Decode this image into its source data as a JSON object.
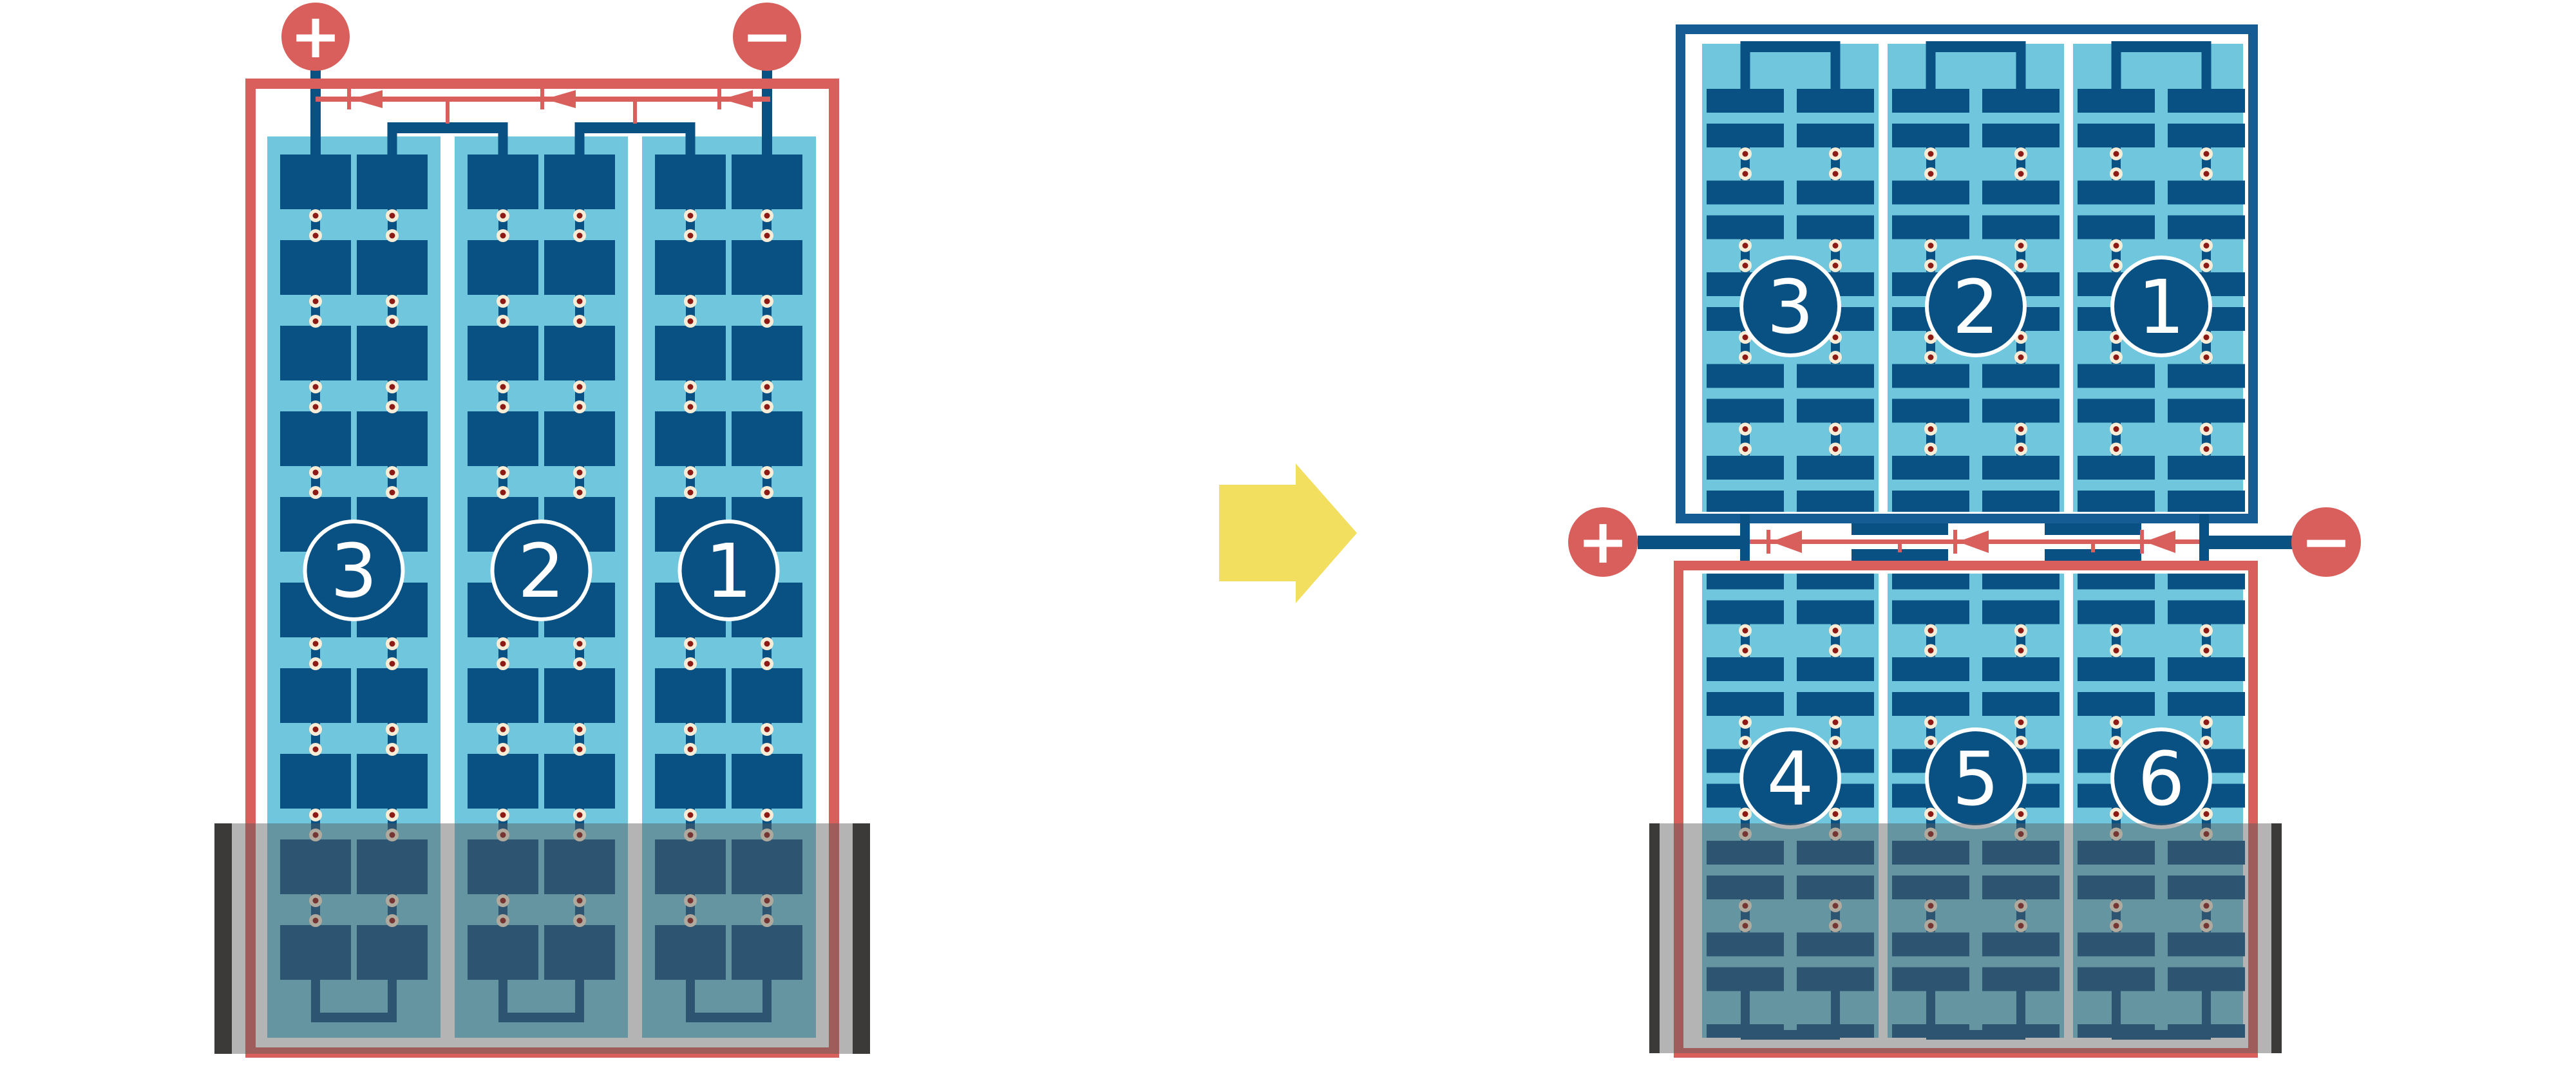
{
  "title": "Battery cell-stack series connection diagram: single battery rearranged into stacked dual module pack",
  "colors": {
    "background": "#ffffff",
    "red": "#D85F5B",
    "dark_blue": "#0A5183",
    "frame_blue": "#155C94",
    "light_blue": "#6FC6DD",
    "cream": "#F7EDD7",
    "dot_red": "#8C1A15",
    "yellow": "#F2DF5F",
    "charcoal": "#3B3A39",
    "tray_overlay": "rgba(88,88,88,0.45)",
    "circle_stroke": "#ffffff",
    "label_text": "#ffffff"
  },
  "terminals": {
    "plus": "+",
    "minus": "−"
  },
  "icons": [
    "plus-terminal-icon",
    "minus-terminal-icon",
    "diode-arrow-icon",
    "transform-arrow-icon",
    "cell-connector-dot-icon"
  ],
  "modules": {
    "left_battery": {
      "labels": [
        "3",
        "2",
        "1"
      ],
      "columns": 3,
      "cell_rows": 10,
      "sub_columns_per_column": 2,
      "diode_arrows": 3,
      "orientation": "single tall module, terminals on top, tray at bottom"
    },
    "stacked_top": {
      "labels": [
        "3",
        "2",
        "1"
      ],
      "columns": 3,
      "cell_row_pairs": 5,
      "orientation": "flipped (jumpers on top, terminals at bottom edge)"
    },
    "stacked_bottom": {
      "labels": [
        "4",
        "5",
        "6"
      ],
      "columns": 3,
      "cell_row_pairs": 6,
      "orientation": "upright (terminals at top edge, tray at bottom)"
    },
    "junction": {
      "diode_arrows": 3,
      "direction": "current arrows point left toward plus terminal"
    }
  }
}
